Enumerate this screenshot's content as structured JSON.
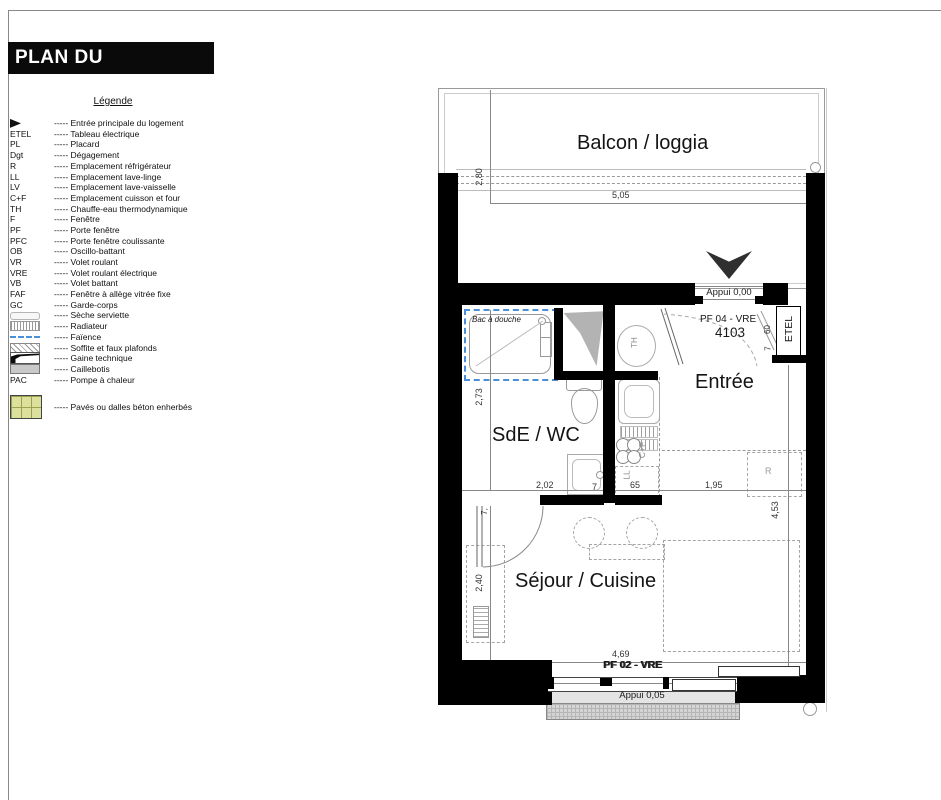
{
  "page": {
    "title": "PLAN DU LOGEMENT"
  },
  "legend": {
    "heading": "Légende",
    "dash": "-----",
    "items": [
      {
        "sym": "arrow",
        "abbr": "",
        "label": "Entrée principale du logement"
      },
      {
        "sym": "text",
        "abbr": "ETEL",
        "label": "Tableau électrique"
      },
      {
        "sym": "text",
        "abbr": "PL",
        "label": "Placard"
      },
      {
        "sym": "text",
        "abbr": "Dgt",
        "label": "Dégagement"
      },
      {
        "sym": "text",
        "abbr": "R",
        "label": "Emplacement réfrigérateur"
      },
      {
        "sym": "text",
        "abbr": "LL",
        "label": "Emplacement lave-linge"
      },
      {
        "sym": "text",
        "abbr": "LV",
        "label": "Emplacement lave-vaisselle"
      },
      {
        "sym": "text",
        "abbr": "C+F",
        "label": "Emplacement cuisson et four"
      },
      {
        "sym": "text",
        "abbr": "TH",
        "label": "Chauffe-eau thermodynamique"
      },
      {
        "sym": "text",
        "abbr": "F",
        "label": "Fenêtre"
      },
      {
        "sym": "text",
        "abbr": "PF",
        "label": "Porte fenêtre"
      },
      {
        "sym": "text",
        "abbr": "PFC",
        "label": "Porte fenêtre coulissante"
      },
      {
        "sym": "text",
        "abbr": "OB",
        "label": "Oscillo-battant"
      },
      {
        "sym": "text",
        "abbr": "VR",
        "label": "Volet roulant"
      },
      {
        "sym": "text",
        "abbr": "VRE",
        "label": "Volet roulant électrique"
      },
      {
        "sym": "text",
        "abbr": "VB",
        "label": "Volet battant"
      },
      {
        "sym": "text",
        "abbr": "FAF",
        "label": "Fenêtre à allège vitrée fixe"
      },
      {
        "sym": "text",
        "abbr": "GC",
        "label": "Garde-corps"
      },
      {
        "sym": "towel",
        "abbr": "",
        "label": "Sèche serviette"
      },
      {
        "sym": "radiator",
        "abbr": "",
        "label": "Radiateur"
      },
      {
        "sym": "faience",
        "abbr": "",
        "label": "Faïence"
      },
      {
        "sym": "soffit",
        "abbr": "",
        "label": "Soffite et faux plafonds"
      },
      {
        "sym": "duct",
        "abbr": "",
        "label": "Gaine technique"
      },
      {
        "sym": "grating",
        "abbr": "",
        "label": "Caillebotis"
      },
      {
        "sym": "text",
        "abbr": "PAC",
        "label": "Pompe à chaleur"
      },
      {
        "sym": "paving",
        "abbr": "",
        "label": "Pavés ou dalles béton enherbés"
      }
    ]
  },
  "plan": {
    "rooms": {
      "balcony": "Balcon / loggia",
      "entry": "Entrée",
      "bathroom": "SdE / WC",
      "living": "Séjour / Cuisine"
    },
    "labels": {
      "appui_top": "Appui 0,00",
      "appui_bottom": "Appui 0,05",
      "door_top": "PF 04 - VRE",
      "unit_number": "4103",
      "door_bottom": "PF 02 - VRE",
      "etel": "ETEL",
      "shower_tray": "Bac à douche",
      "water_heater": "TH",
      "cooker": "C+F",
      "washer": "LL",
      "fridge": "R"
    },
    "dimensions": {
      "balcony_depth": "2,80",
      "balcony_width": "5,05",
      "bath_height": "2,73",
      "bath_width": "2,02",
      "wall_thickness": "7",
      "kitchen_width": "65",
      "entry_width": "1,95",
      "right_height": "4,53",
      "door_wall": "7,",
      "living_left": "2,40",
      "living_width": "4,69",
      "etel_h": "60",
      "etel_w": "7"
    },
    "colors": {
      "wall": "#000000",
      "faience": "#4a90d9",
      "paving_fill": "#dce09d"
    }
  }
}
